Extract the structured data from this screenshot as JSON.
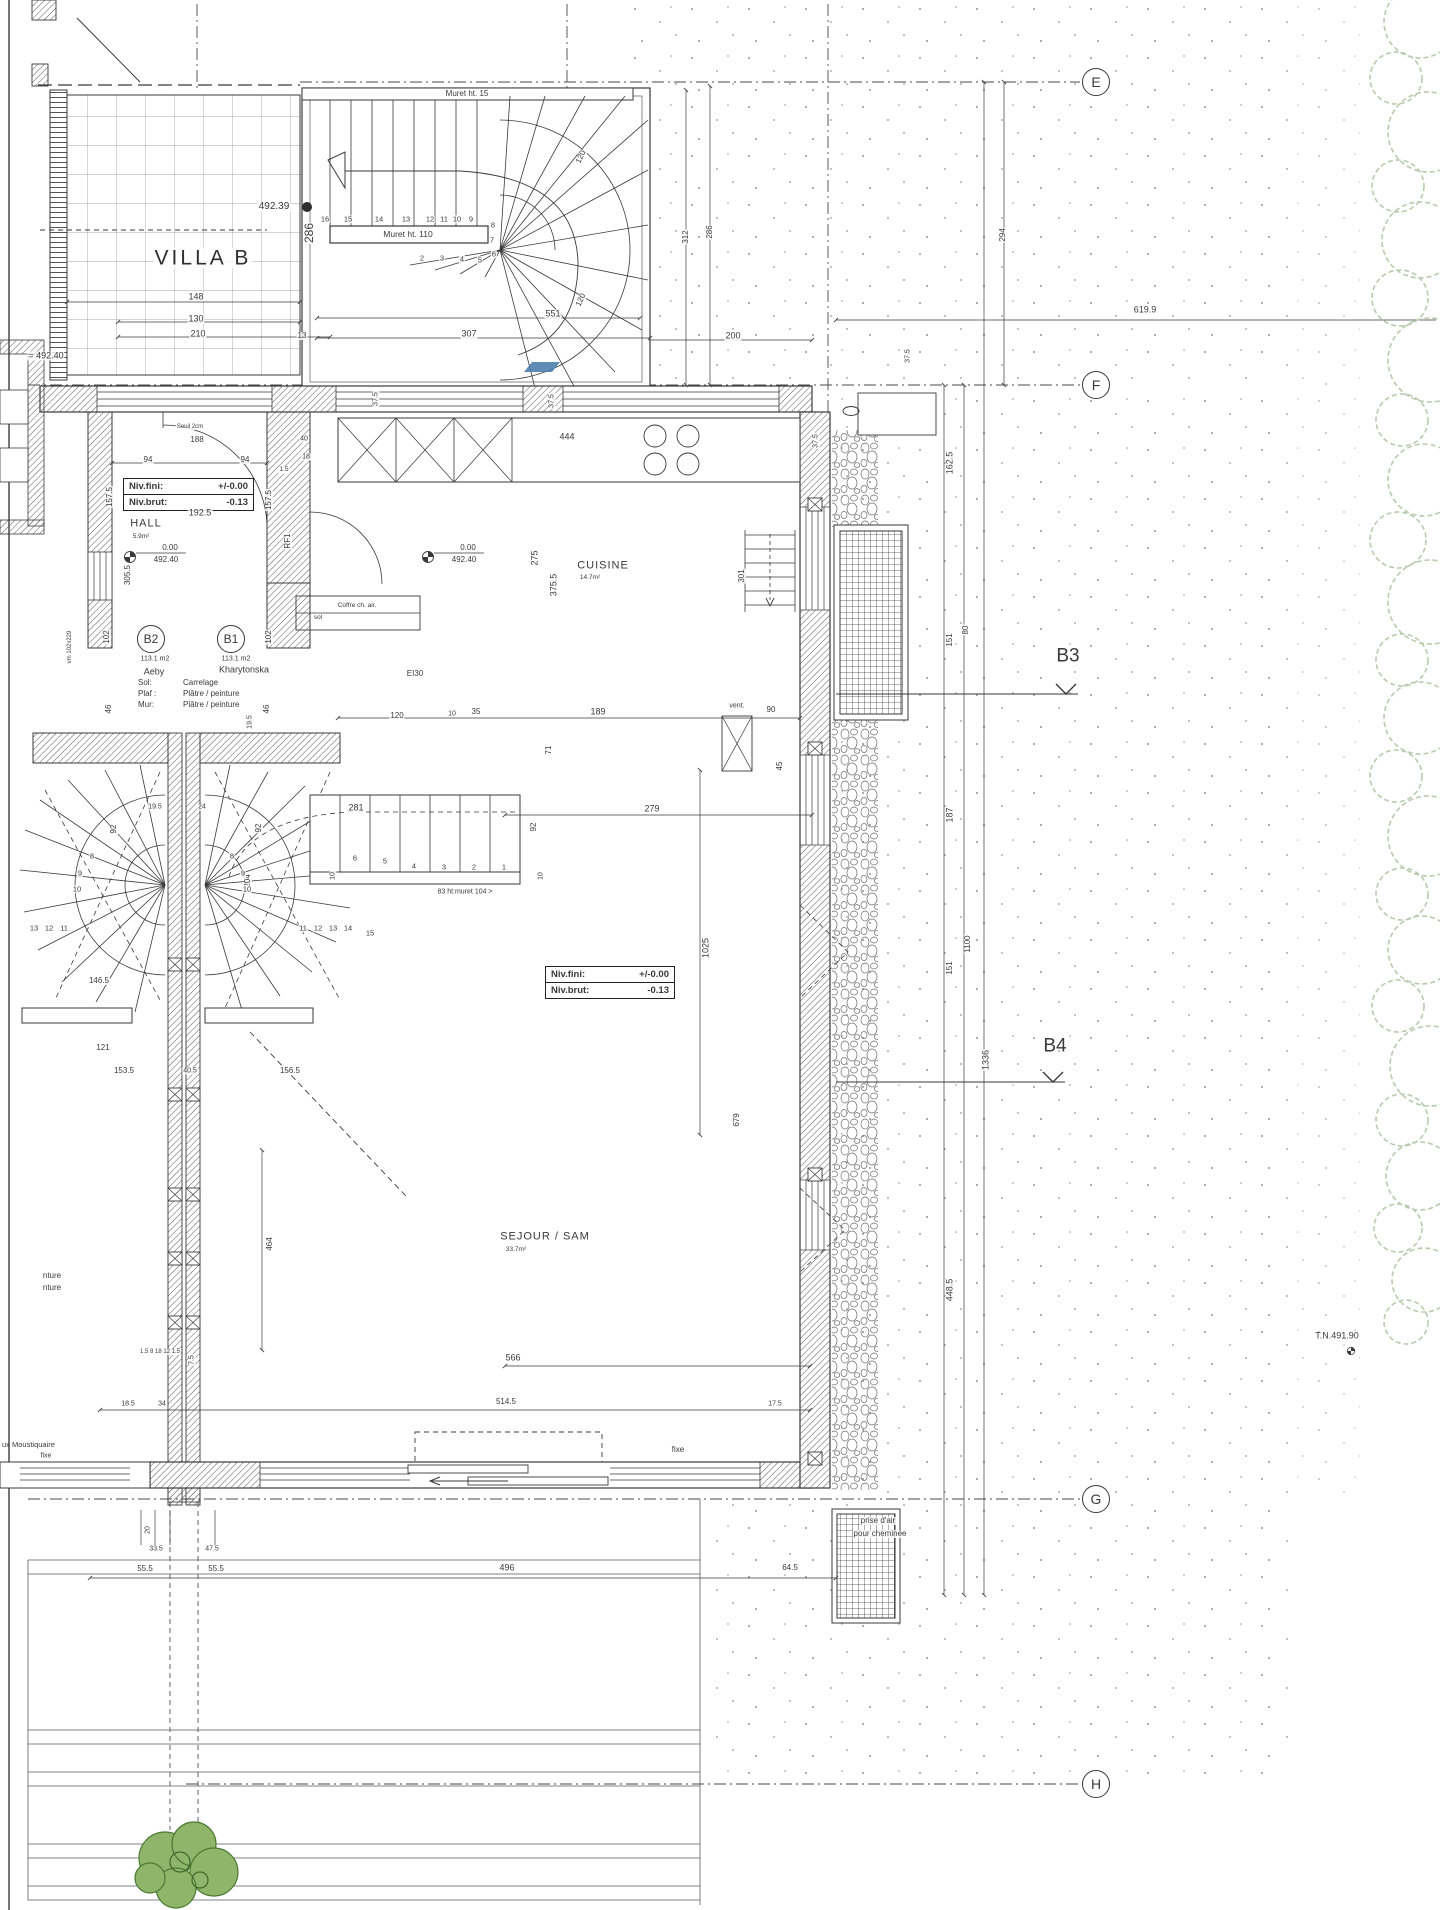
{
  "villa_title": "VILLA B",
  "grid_markers": [
    {
      "label": "E"
    },
    {
      "label": "F"
    },
    {
      "label": "G"
    },
    {
      "label": "H"
    }
  ],
  "section_markers": [
    {
      "label": "B3"
    },
    {
      "label": "B4"
    }
  ],
  "rooms": {
    "hall": {
      "name": "HALL",
      "area": "5.9m²"
    },
    "cuisine": {
      "name": "CUISINE",
      "area": "14.7m²"
    },
    "sejour": {
      "name": "SEJOUR / SAM",
      "area": "33.7m²"
    }
  },
  "units": {
    "b2": {
      "id": "B2",
      "area": "113.1 m2",
      "owner": "Aeby"
    },
    "b1": {
      "id": "B1",
      "area": "113.1 m2",
      "owner": "Kharytonska"
    },
    "finishes": [
      {
        "k": "Sol:",
        "v": "Carrelage"
      },
      {
        "k": "Plaf :",
        "v": "Plâtre / peinture"
      },
      {
        "k": "Mur:",
        "v": "Plâtre / peinture"
      }
    ]
  },
  "level_boxes": [
    {
      "fini_label": "Niv.fini:",
      "fini": "+/-0.00",
      "brut_label": "Niv.brut:",
      "brut": "-0.13"
    },
    {
      "fini_label": "Niv.fini:",
      "fini": "+/-0.00",
      "brut_label": "Niv.brut:",
      "brut": "-0.13"
    }
  ],
  "levels": {
    "hall_a": "0.00",
    "hall_b": "492.40",
    "cuisine_a": "0.00",
    "cuisine_b": "492.40",
    "bench": "492.39",
    "left": "= 492.40",
    "tn": "T.N.491.90"
  },
  "murets": {
    "top": "Muret ht. 15",
    "mid": "Muret ht. 110",
    "stair": "83 ht:muret 104 >"
  },
  "notes": {
    "vent": "vent.",
    "ei30": "EI30",
    "coffre1": "Coffre ch. air.",
    "coffre2": "sol",
    "fixe_door": "fixe",
    "fixe_left": "fixe",
    "moustiquaire": "ux Moustiquaire",
    "prise1": "prise d'air",
    "prise2": "pour cheminée",
    "frag1": "nture",
    "frag2": "nture",
    "dim619": "619.9"
  },
  "dim_labels": [
    {
      "t": "148",
      "x": 196,
      "y": 297
    },
    {
      "t": "130",
      "x": 196,
      "y": 319
    },
    {
      "t": "210",
      "x": 198,
      "y": 334
    },
    {
      "t": "13",
      "x": 302,
      "y": 336,
      "s": 8
    },
    {
      "t": "307",
      "x": 469,
      "y": 334
    },
    {
      "t": "551",
      "x": 553,
      "y": 314
    },
    {
      "t": "200",
      "x": 733,
      "y": 336
    },
    {
      "t": "120",
      "x": 581,
      "y": 157,
      "r": -65,
      "s": 8
    },
    {
      "t": "120",
      "x": 581,
      "y": 300,
      "r": -65,
      "s": 8
    },
    {
      "t": "312",
      "x": 686,
      "y": 237,
      "r": -90,
      "s": 8
    },
    {
      "t": "286",
      "x": 710,
      "y": 232,
      "r": -90,
      "s": 8
    },
    {
      "t": "294",
      "x": 1003,
      "y": 235,
      "r": -90,
      "s": 8
    },
    {
      "t": "286",
      "x": 309,
      "y": 233,
      "r": -90,
      "s": 12
    },
    {
      "t": "37.5",
      "x": 376,
      "y": 399,
      "r": -90,
      "s": 7
    },
    {
      "t": "37.5",
      "x": 552,
      "y": 401,
      "r": -90,
      "s": 7
    },
    {
      "t": "37.5",
      "x": 816,
      "y": 441,
      "r": -90,
      "s": 7
    },
    {
      "t": "37.5",
      "x": 908,
      "y": 356,
      "r": -90,
      "s": 7
    },
    {
      "t": "444",
      "x": 567,
      "y": 437
    },
    {
      "t": "188",
      "x": 197,
      "y": 440,
      "s": 8
    },
    {
      "t": "Seuil 2cm",
      "x": 190,
      "y": 427,
      "s": 6
    },
    {
      "t": "94",
      "x": 148,
      "y": 460,
      "s": 8
    },
    {
      "t": "94",
      "x": 245,
      "y": 460,
      "s": 8
    },
    {
      "t": "157.5",
      "x": 110,
      "y": 497,
      "r": -90,
      "s": 8
    },
    {
      "t": "157.5",
      "x": 269,
      "y": 500,
      "r": -90,
      "s": 8
    },
    {
      "t": "192.5",
      "x": 200,
      "y": 513
    },
    {
      "t": "40",
      "x": 304,
      "y": 439,
      "s": 7
    },
    {
      "t": "18",
      "x": 306,
      "y": 457,
      "s": 7
    },
    {
      "t": "1.5",
      "x": 284,
      "y": 470,
      "s": 6.5
    },
    {
      "t": "305.5",
      "x": 128,
      "y": 575,
      "r": -90,
      "s": 8
    },
    {
      "t": "RF1",
      "x": 288,
      "y": 541,
      "r": -90,
      "s": 8
    },
    {
      "t": "102",
      "x": 107,
      "y": 637,
      "r": -90,
      "s": 8
    },
    {
      "t": "102",
      "x": 269,
      "y": 637,
      "r": -90,
      "s": 8
    },
    {
      "t": "46",
      "x": 109,
      "y": 709,
      "r": -90,
      "s": 8
    },
    {
      "t": "46",
      "x": 267,
      "y": 709,
      "r": -90,
      "s": 8
    },
    {
      "t": "19.5",
      "x": 250,
      "y": 722,
      "r": -90,
      "s": 7
    },
    {
      "t": "vm 102x229",
      "x": 70,
      "y": 647,
      "r": -90,
      "s": 6
    },
    {
      "t": "275",
      "x": 535,
      "y": 558,
      "r": -90
    },
    {
      "t": "375.5",
      "x": 554,
      "y": 585,
      "r": -90
    },
    {
      "t": "301",
      "x": 742,
      "y": 576,
      "r": -90,
      "s": 8
    },
    {
      "t": "162.5",
      "x": 950,
      "y": 463,
      "r": -90
    },
    {
      "t": "151",
      "x": 950,
      "y": 640,
      "r": -90,
      "s": 8
    },
    {
      "t": "80",
      "x": 966,
      "y": 630,
      "r": -90,
      "s": 8
    },
    {
      "t": "187",
      "x": 950,
      "y": 815,
      "r": -90
    },
    {
      "t": "151",
      "x": 950,
      "y": 968,
      "r": -90,
      "s": 8
    },
    {
      "t": "1100",
      "x": 968,
      "y": 944,
      "r": -90,
      "s": 8
    },
    {
      "t": "1336",
      "x": 986,
      "y": 1060,
      "r": -90
    },
    {
      "t": "448.5",
      "x": 950,
      "y": 1290,
      "r": -90
    },
    {
      "t": "120",
      "x": 397,
      "y": 716,
      "s": 8
    },
    {
      "t": "10",
      "x": 452,
      "y": 714,
      "s": 7
    },
    {
      "t": "35",
      "x": 476,
      "y": 712,
      "s": 8
    },
    {
      "t": "189",
      "x": 598,
      "y": 712
    },
    {
      "t": "90",
      "x": 771,
      "y": 710,
      "s": 8
    },
    {
      "t": "71",
      "x": 549,
      "y": 750,
      "r": -90,
      "s": 8
    },
    {
      "t": "45",
      "x": 780,
      "y": 766,
      "r": -90,
      "s": 8
    },
    {
      "t": "281",
      "x": 356,
      "y": 808
    },
    {
      "t": "279",
      "x": 652,
      "y": 809
    },
    {
      "t": "92",
      "x": 534,
      "y": 827,
      "r": -90,
      "s": 8
    },
    {
      "t": "10",
      "x": 541,
      "y": 876,
      "r": -90,
      "s": 7
    },
    {
      "t": "19.5",
      "x": 155,
      "y": 807,
      "s": 7
    },
    {
      "t": "24",
      "x": 202,
      "y": 807,
      "s": 7
    },
    {
      "t": "92",
      "x": 114,
      "y": 829,
      "r": -90,
      "s": 8
    },
    {
      "t": "92",
      "x": 259,
      "y": 828,
      "r": -90,
      "s": 8
    },
    {
      "t": "204",
      "x": 248,
      "y": 881,
      "r": -90,
      "s": 8
    },
    {
      "t": "10",
      "x": 333,
      "y": 876,
      "r": -90,
      "s": 7
    },
    {
      "t": "1025",
      "x": 706,
      "y": 948,
      "r": -90
    },
    {
      "t": "679",
      "x": 737,
      "y": 1120,
      "r": -90,
      "s": 8
    },
    {
      "t": "464",
      "x": 270,
      "y": 1244,
      "r": -90,
      "s": 8
    },
    {
      "t": "146.5",
      "x": 99,
      "y": 981,
      "s": 8
    },
    {
      "t": "121",
      "x": 103,
      "y": 1048,
      "s": 8
    },
    {
      "t": "153.5",
      "x": 124,
      "y": 1071,
      "s": 8
    },
    {
      "t": "40.5",
      "x": 190,
      "y": 1071,
      "s": 7
    },
    {
      "t": "156.5",
      "x": 290,
      "y": 1071,
      "s": 8
    },
    {
      "t": "566",
      "x": 513,
      "y": 1358
    },
    {
      "t": "514.5",
      "x": 506,
      "y": 1402,
      "s": 8
    },
    {
      "t": "17.5",
      "x": 775,
      "y": 1404,
      "s": 7
    },
    {
      "t": "18.5",
      "x": 128,
      "y": 1404,
      "s": 7
    },
    {
      "t": "34",
      "x": 162,
      "y": 1404,
      "s": 7
    },
    {
      "t": "7.5",
      "x": 192,
      "y": 1360,
      "r": -90,
      "s": 7
    },
    {
      "t": "1.5 8 18 12 1.5",
      "x": 160,
      "y": 1352,
      "s": 6
    },
    {
      "t": "496",
      "x": 507,
      "y": 1568
    },
    {
      "t": "64.5",
      "x": 790,
      "y": 1568,
      "s": 8
    },
    {
      "t": "55.5",
      "x": 145,
      "y": 1569,
      "s": 8
    },
    {
      "t": "55.5",
      "x": 216,
      "y": 1569,
      "s": 8
    },
    {
      "t": "47.5",
      "x": 212,
      "y": 1549,
      "s": 7
    },
    {
      "t": "33.5",
      "x": 156,
      "y": 1549,
      "s": 7
    },
    {
      "t": "20",
      "x": 148,
      "y": 1530,
      "r": -90,
      "s": 7
    }
  ],
  "stair_numbers": [
    {
      "t": "16",
      "x": 325,
      "y": 219
    },
    {
      "t": "15",
      "x": 348,
      "y": 219
    },
    {
      "t": "14",
      "x": 379,
      "y": 219
    },
    {
      "t": "13",
      "x": 406,
      "y": 219
    },
    {
      "t": "12",
      "x": 430,
      "y": 219
    },
    {
      "t": "11",
      "x": 444,
      "y": 219
    },
    {
      "t": "10",
      "x": 457,
      "y": 219
    },
    {
      "t": "9",
      "x": 471,
      "y": 219
    },
    {
      "t": "8",
      "x": 493,
      "y": 225
    },
    {
      "t": "7",
      "x": 492,
      "y": 240
    },
    {
      "t": "6",
      "x": 494,
      "y": 254
    },
    {
      "t": "5",
      "x": 480,
      "y": 260
    },
    {
      "t": "4",
      "x": 462,
      "y": 259
    },
    {
      "t": "3",
      "x": 442,
      "y": 258
    },
    {
      "t": "2",
      "x": 422,
      "y": 258
    },
    {
      "t": "1",
      "x": 504,
      "y": 867
    },
    {
      "t": "2",
      "x": 474,
      "y": 867
    },
    {
      "t": "3",
      "x": 444,
      "y": 867
    },
    {
      "t": "4",
      "x": 414,
      "y": 866
    },
    {
      "t": "5",
      "x": 385,
      "y": 861
    },
    {
      "t": "6",
      "x": 355,
      "y": 858
    },
    {
      "t": "8",
      "x": 232,
      "y": 856
    },
    {
      "t": "9",
      "x": 243,
      "y": 873
    },
    {
      "t": "10",
      "x": 247,
      "y": 889
    },
    {
      "t": "11",
      "x": 303,
      "y": 928
    },
    {
      "t": "12",
      "x": 318,
      "y": 928
    },
    {
      "t": "13",
      "x": 333,
      "y": 928
    },
    {
      "t": "14",
      "x": 348,
      "y": 928
    },
    {
      "t": "15",
      "x": 370,
      "y": 933
    },
    {
      "t": "8",
      "x": 92,
      "y": 856
    },
    {
      "t": "9",
      "x": 80,
      "y": 873
    },
    {
      "t": "10",
      "x": 77,
      "y": 889
    },
    {
      "t": "11",
      "x": 64,
      "y": 928
    },
    {
      "t": "12",
      "x": 49,
      "y": 928
    },
    {
      "t": "13",
      "x": 34,
      "y": 928
    }
  ],
  "vegetation": {
    "trees": [
      [
        1420,
        22,
        36
      ],
      [
        1396,
        78,
        26
      ],
      [
        1428,
        132,
        40
      ],
      [
        1398,
        186,
        26
      ],
      [
        1420,
        240,
        38
      ],
      [
        1400,
        298,
        28
      ],
      [
        1430,
        360,
        42
      ],
      [
        1402,
        420,
        26
      ],
      [
        1424,
        480,
        36
      ],
      [
        1398,
        540,
        28
      ],
      [
        1430,
        602,
        42
      ],
      [
        1402,
        660,
        26
      ],
      [
        1420,
        718,
        36
      ],
      [
        1396,
        776,
        26
      ],
      [
        1428,
        836,
        40
      ],
      [
        1402,
        894,
        26
      ],
      [
        1422,
        950,
        34
      ],
      [
        1398,
        1006,
        26
      ],
      [
        1430,
        1066,
        40
      ],
      [
        1402,
        1120,
        26
      ],
      [
        1420,
        1176,
        34
      ],
      [
        1398,
        1228,
        24
      ],
      [
        1424,
        1280,
        32
      ],
      [
        1406,
        1322,
        22
      ]
    ]
  },
  "colors": {
    "line": "#3a3a3a",
    "glass_blue": "#4d7fae",
    "veg": "#b7cbae",
    "shrub_fill": "#8fb56b",
    "shrub_stroke": "#4c7a33"
  }
}
